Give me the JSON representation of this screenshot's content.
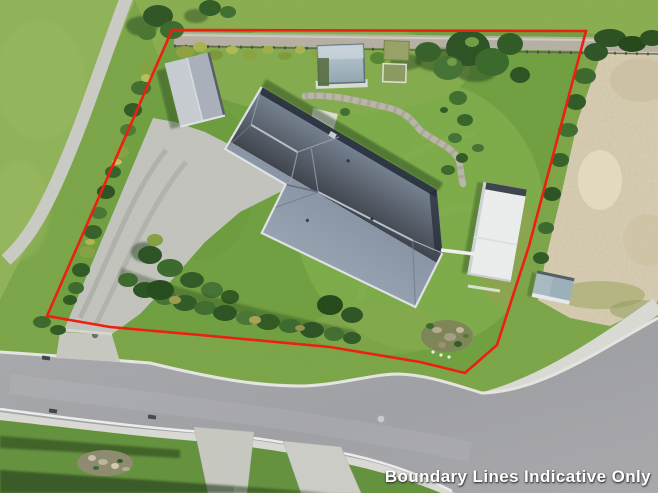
{
  "watermark": {
    "text": "Boundary Lines Indicative Only",
    "color": "#ffffff"
  },
  "boundary_overlay": {
    "color": "#ee1c0c",
    "style": "solid",
    "points": "172,30 586,31 529,246 497,345 465,373 420,362 330,347 200,335 110,327 47,316"
  },
  "scene": {
    "type": "aerial-drone-photo",
    "subject": "residential property with red boundary line overlay",
    "features": [
      "main-house-hip-roof",
      "detached-garage",
      "white-outbuilding",
      "garden-shed",
      "swimming-pool",
      "raised-garden-beds",
      "concrete-driveway",
      "street-road",
      "footpath",
      "gravel-access-road",
      "bare-sand-lot",
      "lawn",
      "hedges-and-trees",
      "rock-garden",
      "neighbour-driveways"
    ],
    "palette": {
      "lawn_green": "#6f9f3f",
      "bright_lawn": "#7cab48",
      "tree_green": "#2e5424",
      "roof_blue_gray": "#8793a4",
      "garage_roof_gray": "#b9bec6",
      "road_asphalt": "#a4a5a9",
      "concrete": "#c6c8c1",
      "footpath_white": "#d9dad4",
      "sand_lot": "#d9cfb4",
      "boundary_red": "#ee1c0c",
      "watermark_white": "#ffffff"
    }
  }
}
